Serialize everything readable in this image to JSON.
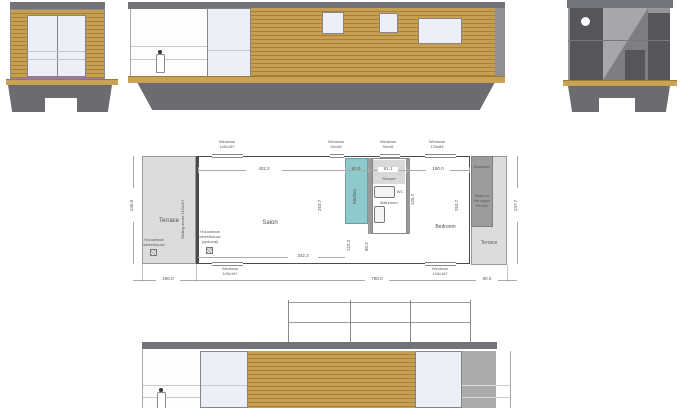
{
  "drawing": {
    "type": "houseboat plan and elevations",
    "colors": {
      "wood": "#c79f52",
      "wood_dark": "#aa8036",
      "roof_gray": "#73737a",
      "hull_gray": "#6b6b70",
      "glass": "#edeff6",
      "plan_terrace": "#dcdcdc",
      "kitchen_teal": "#8ec9cc",
      "stair_gray": "#9c9c9c"
    }
  },
  "plan": {
    "rooms": {
      "terrace_left": "Terrace",
      "salon": "Salon",
      "kitchen": "Kitchen",
      "shower": "Shower",
      "wc": "WC",
      "bathroom": "Bathroom",
      "bedroom": "Bedroom",
      "staircase": "Staircase",
      "stairs_note": "Stairs to\nthe upper\nterrace",
      "terrace_right": "Terrace"
    },
    "annotations": {
      "sliding_doors": "Sliding doors 215x197",
      "wheelhouse": "Houseboat\nwheelhouse",
      "wheelhouse_optional": "Houseboat\nwheelhouse\n(optional)"
    },
    "windows": {
      "top_left": "Windows\n145x167",
      "top_kitchen": "Windows\n94x46",
      "top_bath": "Windows\n94x46",
      "top_right": "Windows\n123x84",
      "bottom_left": "Windows\n145x167",
      "bottom_right": "Windows\n140x167"
    },
    "dims": {
      "salon_w": "402.2",
      "kitchen_w": "60.0",
      "bath_w": "81.1",
      "bedroom_w": "180.0",
      "left_h": "245.0",
      "salon_h": "253.7",
      "bedroom_h": "253.7",
      "terrace_right_h": "237.7",
      "bath_h": "125.7",
      "kitchen_lower_h": "122.2",
      "bath_lower_h": "80.2",
      "salon_bottom_w": "342.3",
      "total_left": "190.0",
      "total_mid": "780.0",
      "total_right": "80.0"
    }
  }
}
